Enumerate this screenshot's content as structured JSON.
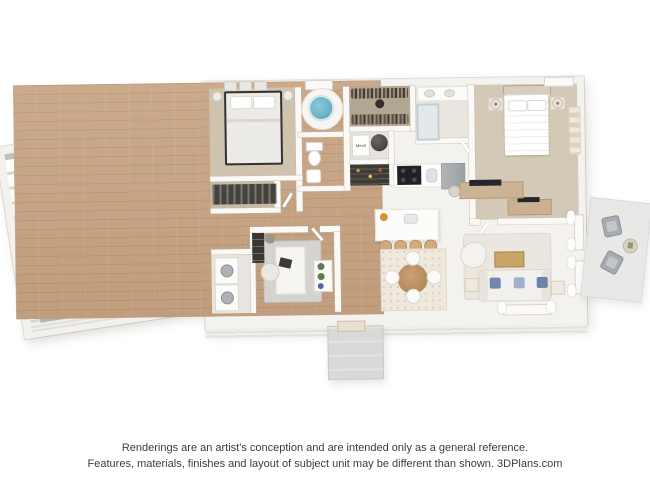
{
  "footer": {
    "line1": "Renderings are an artist's conception and are intended only as a general reference.",
    "line2": "Features, materials, finishes and layout of subject unit may be different than shown. 3DPlans.com"
  },
  "labels": {
    "mech_closet": "Mech"
  },
  "scene": {
    "type": "3d-floor-plan-rendering",
    "rooms": [
      "two-car-garage",
      "bedroom",
      "hall-bathroom",
      "walk-in-closet",
      "mechanical-closet",
      "pantry",
      "master-bathroom",
      "master-bedroom",
      "kitchen",
      "dining-area",
      "office",
      "laundry-closet",
      "living-room",
      "front-porch",
      "patio"
    ],
    "furniture": [
      "black-car",
      "silver-car",
      "metal-frame-bed",
      "round-soaking-tub",
      "toilet",
      "pedestal-sink",
      "clothes-rods",
      "water-heater",
      "double-vanity",
      "walk-in-shower",
      "master-bed",
      "nightstands-with-lamps",
      "dresser-with-tv",
      "kitchen-island",
      "bar-stools",
      "range",
      "refrigerator",
      "round-dining-table",
      "dining-chairs",
      "desk",
      "office-chair",
      "stacked-washer-dryer",
      "sofa-with-blue-pillows",
      "coffee-table",
      "armchair",
      "tv-console",
      "floor-lamp",
      "patio-chairs",
      "patio-side-table"
    ]
  },
  "colors": {
    "background": "#ffffff",
    "walls": "#f4f2ee",
    "wood_floor": "#c7a587",
    "carpet": "#cfc2ae",
    "garage_concrete": "#b9bab8",
    "tub_water": "#57a8c0",
    "sofa_pillow_blue": "#7486ac",
    "car_black": "#1a1b1d",
    "car_silver": "#dcdee0",
    "patio_concrete": "#e7e7e5",
    "footer_text": "#3c3c3c"
  }
}
